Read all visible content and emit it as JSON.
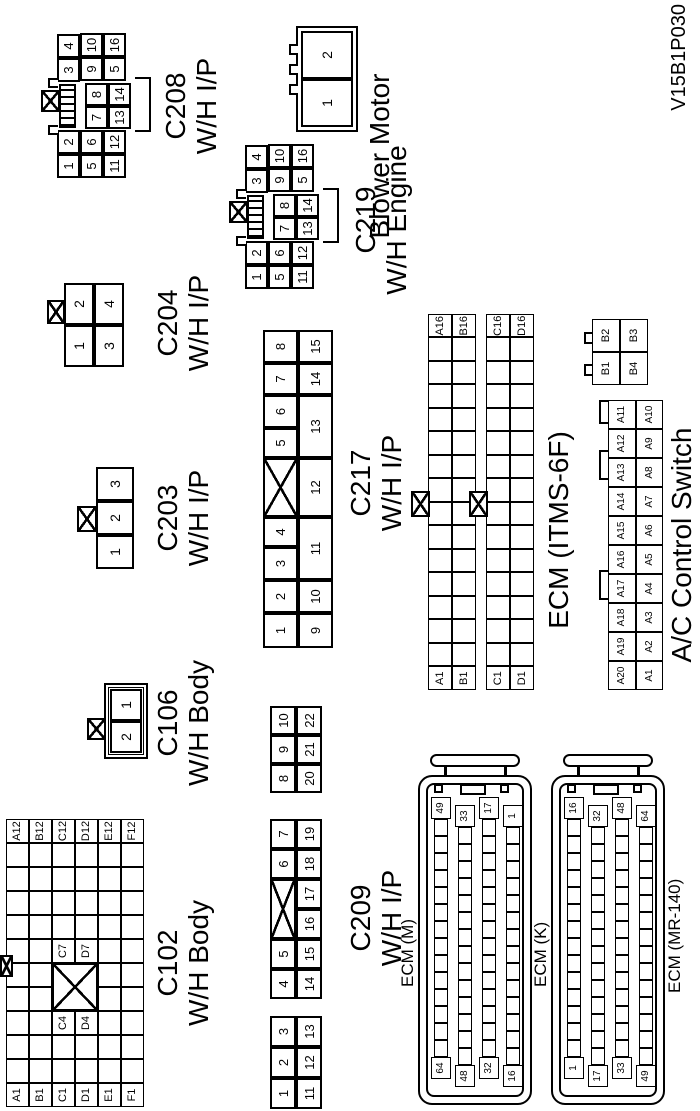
{
  "figure_id": "V15B1P030",
  "colors": {
    "line": "#000000",
    "background": "#ffffff"
  },
  "connectors": {
    "c102": {
      "title": "C102",
      "subtitle": "W/H Body",
      "rows": 6,
      "cols": 12,
      "labeled_cells": [
        {
          "r": 0,
          "c": 0,
          "t": "A1"
        },
        {
          "r": 1,
          "c": 0,
          "t": "B1"
        },
        {
          "r": 2,
          "c": 0,
          "t": "C1"
        },
        {
          "r": 3,
          "c": 0,
          "t": "D1"
        },
        {
          "r": 4,
          "c": 0,
          "t": "E1"
        },
        {
          "r": 5,
          "c": 0,
          "t": "F1"
        },
        {
          "r": 0,
          "c": 11,
          "t": "A12"
        },
        {
          "r": 1,
          "c": 11,
          "t": "B12"
        },
        {
          "r": 2,
          "c": 11,
          "t": "C12"
        },
        {
          "r": 3,
          "c": 11,
          "t": "D12"
        },
        {
          "r": 4,
          "c": 11,
          "t": "E12"
        },
        {
          "r": 5,
          "c": 11,
          "t": "F12"
        },
        {
          "r": 2,
          "c": 3,
          "t": "C4"
        },
        {
          "r": 3,
          "c": 3,
          "t": "D4"
        },
        {
          "r": 2,
          "c": 6,
          "t": "C7"
        },
        {
          "r": 3,
          "c": 6,
          "t": "D7"
        }
      ]
    },
    "c106": {
      "title": "C106",
      "subtitle": "W/H Body",
      "cells": [
        "2",
        "1"
      ]
    },
    "c203": {
      "title": "C203",
      "subtitle": "W/H I/P",
      "cells": [
        "1",
        "2",
        "3"
      ]
    },
    "c204": {
      "title": "C204",
      "subtitle": "W/H I/P",
      "row1": [
        "1",
        "2"
      ],
      "row2": [
        "3",
        "4"
      ]
    },
    "c208": {
      "title": "C208",
      "subtitle": "W/H I/P",
      "row1": [
        "1",
        "2",
        "3",
        "4"
      ],
      "row2": [
        "5",
        "6",
        "7",
        "8",
        "9",
        "10"
      ],
      "row3": [
        "11",
        "12",
        "13",
        "14",
        "5",
        "16"
      ]
    },
    "c219": {
      "title": "C219",
      "subtitle": "W/H Engine",
      "row1": [
        "1",
        "2",
        "3",
        "4"
      ],
      "row2": [
        "5",
        "6",
        "7",
        "8",
        "9",
        "10"
      ],
      "row3": [
        "11",
        "12",
        "13",
        "14",
        "5",
        "16"
      ]
    },
    "blower": {
      "title": "Blower Motor",
      "cells": [
        "1",
        "2"
      ]
    },
    "c209": {
      "title": "C209",
      "subtitle": "W/H I/P",
      "row1": [
        "1",
        "2",
        "3",
        "4",
        "5",
        "X",
        "6",
        "7",
        "8",
        "9",
        "10"
      ],
      "row2": [
        "11",
        "12",
        "13",
        "14",
        "15",
        "16",
        "17",
        "18",
        "19",
        "20",
        "21",
        "22"
      ]
    },
    "c217": {
      "title": "C217",
      "subtitle": "W/H I/P",
      "row1": [
        "1",
        "2",
        "3",
        "4",
        "X",
        "5",
        "6",
        "7",
        "8"
      ],
      "row2": [
        "9",
        "10",
        "11",
        "12",
        "13",
        "14",
        "15"
      ]
    },
    "ecm_itms": {
      "title": "ECM (ITMS-6F)",
      "strips": [
        {
          "r1_left": "A1",
          "r1_right": "A16",
          "r2_left": "B1",
          "r2_right": "B16"
        },
        {
          "r1_left": "C1",
          "r1_right": "C16",
          "r2_left": "D1",
          "r2_right": "D16"
        }
      ]
    },
    "ac_switch": {
      "title": "A/C Control Switch",
      "row1": [
        "A20",
        "A19",
        "A18",
        "A17",
        "A16",
        "A15",
        "A14",
        "A13",
        "A12",
        "A11"
      ],
      "row2": [
        "A1",
        "A2",
        "A3",
        "A4",
        "A5",
        "A6",
        "A7",
        "A8",
        "A9",
        "A10"
      ],
      "b_row1": [
        "B1",
        "B2"
      ],
      "b_row2": [
        "B4",
        "B3"
      ]
    },
    "ecm_m": {
      "title": "ECM (M)",
      "rows": [
        [
          "64",
          "49"
        ],
        [
          "48",
          "33"
        ],
        [
          "32",
          "17"
        ],
        [
          "16",
          "1"
        ]
      ],
      "pins_per_row": 16
    },
    "ecm_k": {
      "title": "ECM (K)",
      "rows": [
        [
          "1",
          "16"
        ],
        [
          "17",
          "32"
        ],
        [
          "33",
          "48"
        ],
        [
          "49",
          "64"
        ]
      ],
      "pins_per_row": 16
    },
    "ecm_mr": {
      "title": "ECM (MR-140)"
    }
  }
}
